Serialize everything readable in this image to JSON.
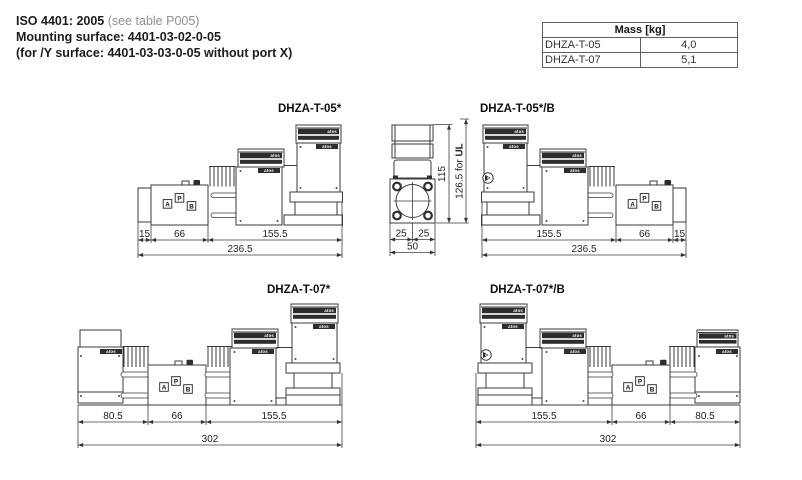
{
  "header": {
    "iso": "ISO 4401: 2005",
    "iso_note": " (see table P005)",
    "mounting": "Mounting surface: 4401-03-02-0-05",
    "y_surface": "(for /Y surface: 4401-03-03-0-05 without port X)"
  },
  "mass_table": {
    "title": "Mass [kg]",
    "rows": [
      {
        "model": "DHZA-T-05",
        "mass": "4,0"
      },
      {
        "model": "DHZA-T-07",
        "mass": "5,1"
      }
    ]
  },
  "logo": "atos",
  "ports": {
    "a": "A",
    "p": "P",
    "b": "B"
  },
  "drawings": {
    "d05": {
      "title": "DHZA-T-05*",
      "dims": [
        "15",
        "66",
        "155.5"
      ],
      "total": "236.5"
    },
    "d05b": {
      "title": "DHZA-T-05*/B",
      "dims": [
        "155.5",
        "66",
        "15"
      ],
      "total": "236.5"
    },
    "d07": {
      "title": "DHZA-T-07*",
      "dims": [
        "80.5",
        "66",
        "155.5"
      ],
      "total": "302"
    },
    "d07b": {
      "title": "DHZA-T-07*/B",
      "dims": [
        "155.5",
        "66",
        "80.5"
      ],
      "total": "302"
    },
    "end_view": {
      "width_dims": [
        "25",
        "25"
      ],
      "width_total": "50",
      "height": "115",
      "height_ul_prefix": "126.5 for ",
      "height_ul": "UL"
    }
  }
}
